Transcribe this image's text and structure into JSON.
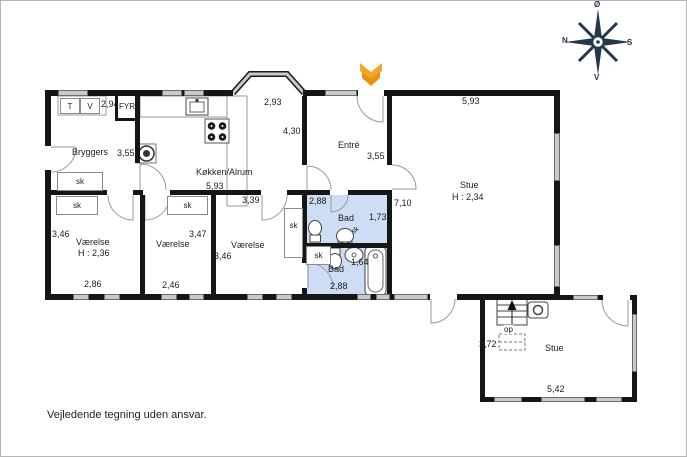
{
  "rooms": {
    "bryggers": {
      "name": "Bryggers",
      "width": "2,94",
      "depth": "3,55"
    },
    "fyr": {
      "name": "FYR"
    },
    "kokken": {
      "name": "Køkken/Alrum",
      "width": "5,93",
      "depth": "4,30"
    },
    "entre": {
      "name": "Entré",
      "width": "2,93",
      "depth": "3,55"
    },
    "stue": {
      "name": "Stue",
      "ceiling": "H : 2,34",
      "width": "5,93",
      "depth": "7,10"
    },
    "vaerelse1": {
      "name": "Værelse",
      "ceiling": "H : 2,36",
      "width": "2,86",
      "depth": "3,46"
    },
    "vaerelse2": {
      "name": "Værelse",
      "width": "2,46",
      "depth": "3,47"
    },
    "vaerelse3": {
      "name": "Værelse",
      "width": "3,39",
      "depth": "3,46"
    },
    "bad1": {
      "name": "Bad",
      "width": "2,88",
      "depth": "1,73"
    },
    "bad2": {
      "name": "Bad",
      "width": "2,88",
      "depth": "1,64"
    },
    "stue2": {
      "name": "Stue",
      "width": "5,42",
      "depth": "3,72"
    }
  },
  "markers": {
    "closet": "sk",
    "stairs_up": "op",
    "dryer": "T",
    "washer": "V"
  },
  "compass": {
    "north": "N",
    "south": "S",
    "east": "Ø",
    "west": "V"
  },
  "footer": {
    "disclaimer": "Vejledende tegning uden ansvar."
  },
  "colors": {
    "wall": "#161616",
    "window": "#c9c9c9",
    "bath_fill": "#cdddf3",
    "arrow": "#f2a62a",
    "compass": "#24364e"
  }
}
